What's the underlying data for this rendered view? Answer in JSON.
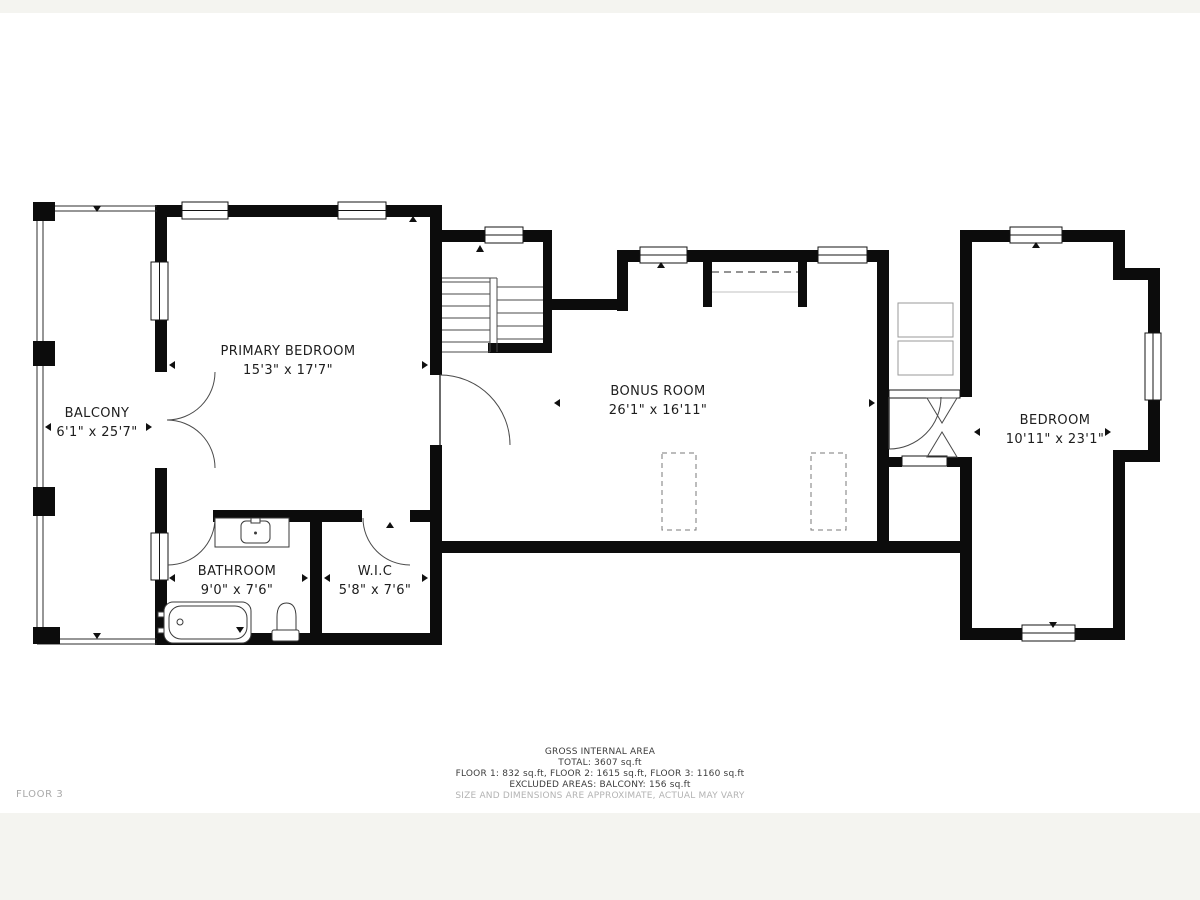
{
  "floor_label": "FLOOR 3",
  "rooms": [
    {
      "name": "BALCONY",
      "dims": "6'1\" x 25'7\""
    },
    {
      "name": "PRIMARY BEDROOM",
      "dims": "15'3\" x 17'7\""
    },
    {
      "name": "BATHROOM",
      "dims": "9'0\" x 7'6\""
    },
    {
      "name": "W.I.C",
      "dims": "5'8\" x 7'6\""
    },
    {
      "name": "BONUS ROOM",
      "dims": "26'1\" x 16'11\""
    },
    {
      "name": "BEDROOM",
      "dims": "10'11\" x 23'1\""
    }
  ],
  "footer": {
    "line1": "GROSS INTERNAL AREA",
    "line2": "TOTAL: 3607 sq.ft",
    "line3": "FLOOR 1: 832 sq.ft, FLOOR 2: 1615 sq.ft, FLOOR 3: 1160 sq.ft",
    "line4": "EXCLUDED AREAS: BALCONY: 156 sq.ft",
    "line5": "SIZE AND DIMENSIONS ARE APPROXIMATE, ACTUAL MAY VARY"
  },
  "colors": {
    "wall": "#0c0c0c",
    "line": "#4a4a4a",
    "background": "#ffffff",
    "band": "#f4f4f0",
    "muted_text": "#b3b3b3"
  }
}
